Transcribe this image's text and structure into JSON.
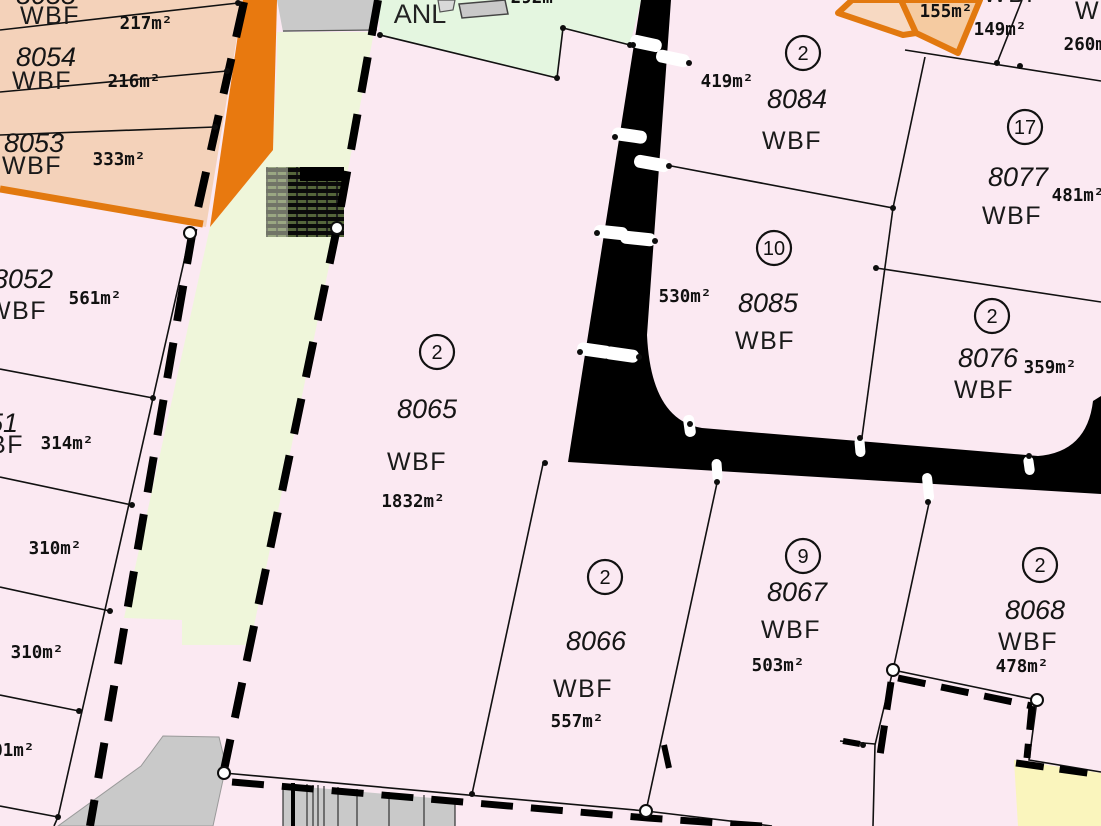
{
  "map": {
    "kind": "cadastral parcel plan",
    "greenway_label": "ANL",
    "colors": {
      "parcel_pink": "#fbe9f2",
      "block_salmon": "#f4d2ba",
      "orange_fill_light": "#f7d9c2",
      "orange_fill": "#f5cba1",
      "orange_border": "#e2790f",
      "greenway_mint": "#e4f6e0",
      "greenway_pale": "#eff6da",
      "road_black": "#000000",
      "building_gray": "#c9c9c9",
      "yellow_zone": "#faf5bd"
    },
    "parcels": {
      "tl_strip_top": {
        "number": "8055",
        "use": "WBF",
        "area": "217m²"
      },
      "p8054": {
        "number": "8054",
        "use": "WBF",
        "area": "216m²"
      },
      "p8053": {
        "number": "8053",
        "use": "WBF",
        "area": "333m²"
      },
      "p8052": {
        "number": "8052",
        "use": "WBF",
        "area": "561m²"
      },
      "p8051": {
        "number": "8051",
        "use": "WBF",
        "area": "314m²"
      },
      "p310a": {
        "area": "310m²"
      },
      "p310b": {
        "area": "310m²"
      },
      "p301": {
        "area": "301m²"
      },
      "p292": {
        "area": "292m²"
      },
      "p8065": {
        "lot": "2",
        "number": "8065",
        "use": "WBF",
        "area": "1832m²"
      },
      "p8066": {
        "lot": "2",
        "number": "8066",
        "use": "WBF",
        "area": "557m²"
      },
      "p8067": {
        "lot": "9",
        "number": "8067",
        "use": "WBF",
        "area": "503m²"
      },
      "p8068": {
        "lot": "2",
        "number": "8068",
        "use": "WBF",
        "area": "478m²"
      },
      "p8084": {
        "lot": "2",
        "number": "8084",
        "use": "WBF",
        "area": "419m²"
      },
      "p8085": {
        "lot": "10",
        "number": "8085",
        "use": "WBF",
        "area": "530m²"
      },
      "p8077": {
        "lot": "17",
        "number": "8077",
        "use": "WBF",
        "area": "481m²"
      },
      "p8076": {
        "lot": "2",
        "number": "8076",
        "use": "WBF",
        "area": "359m²"
      },
      "p155": {
        "area": "155m²"
      },
      "p149": {
        "use": "WBF",
        "area": "149m²"
      },
      "p260": {
        "use": "WBF",
        "area": "260m²"
      }
    }
  }
}
